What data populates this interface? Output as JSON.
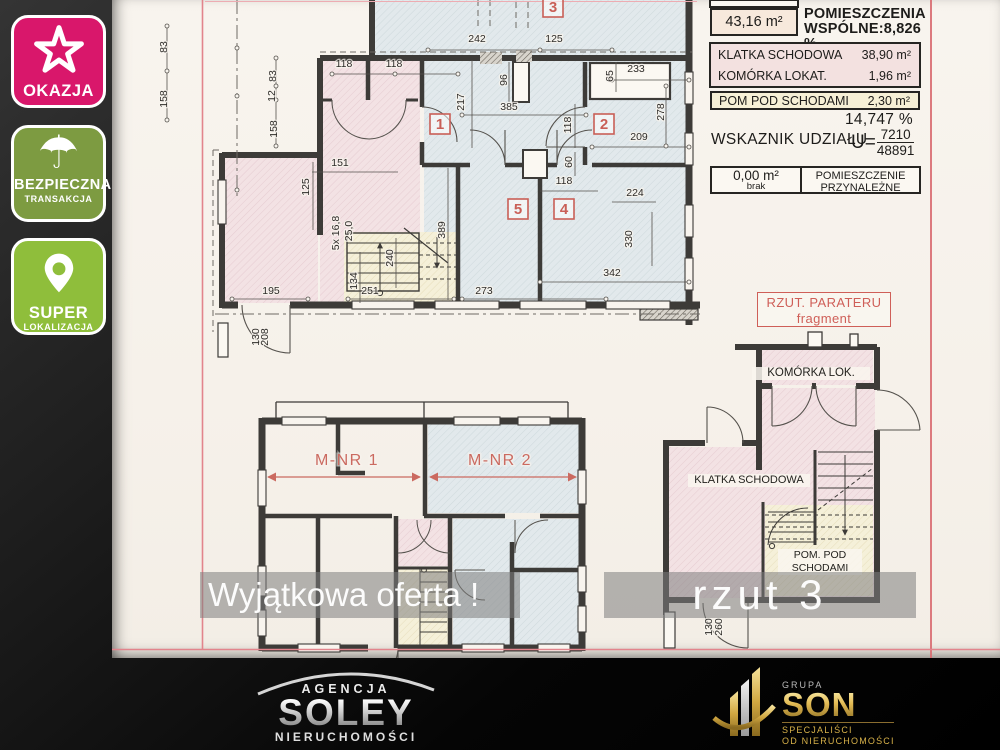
{
  "colors": {
    "accent_red": "#c95f57",
    "border_pink": "#e2848c",
    "badge_pink": "#d9176b",
    "badge_olive": "#7d9b41",
    "badge_green": "#8fbe3b"
  },
  "badges": [
    {
      "label": "OKAZJA",
      "color": "#d9176b",
      "icon": "star-icon"
    },
    {
      "label": "BEZPIECZNA",
      "sublabel": "TRANSAKCJA",
      "color": "#7d9b41",
      "icon": "umbrella-icon"
    },
    {
      "label": "SUPER",
      "sublabel": "LOKALIZACJA",
      "color": "#8fbe3b",
      "icon": "pin-icon"
    }
  ],
  "info_panel": {
    "area_value": "43,16 m²",
    "area_label_line1": "POMIESZCZENIA",
    "area_label_line2": "WSPÓLNE:8,826 %",
    "rows": [
      {
        "label": "KLATKA SCHODOWA",
        "value": "38,90 m²"
      },
      {
        "label": "KOMÓRKA  LOKAT.",
        "value": "1,96 m²"
      },
      {
        "label": "POM POD SCHODAMI",
        "value": "2,30 m²"
      }
    ],
    "share_pct": "14,747 %",
    "share_label": "WSKAZNIK UDZIAŁU",
    "share_u": "U=",
    "share_num": "7210",
    "share_den": "48891",
    "attached_value": "0,00 m²",
    "attached_sub": "brak",
    "attached_label_line1": "POMIESZCZENIE",
    "attached_label_line2": "PRZYNALEŻNE"
  },
  "plan_upper": {
    "room_numbers": [
      {
        "t": "3",
        "x": 553,
        "y": 7
      },
      {
        "t": "1",
        "x": 440,
        "y": 124
      },
      {
        "t": "2",
        "x": 604,
        "y": 124
      },
      {
        "t": "5",
        "x": 518,
        "y": 209
      },
      {
        "t": "4",
        "x": 564,
        "y": 209
      }
    ],
    "dims": [
      {
        "t": "83",
        "x": 167,
        "y": 47,
        "r": -90
      },
      {
        "t": "158",
        "x": 167,
        "y": 99,
        "r": -90
      },
      {
        "t": "83",
        "x": 276,
        "y": 76,
        "r": -90
      },
      {
        "t": "12",
        "x": 275,
        "y": 96,
        "r": -90
      },
      {
        "t": "158",
        "x": 277,
        "y": 129,
        "r": -90
      },
      {
        "t": "242",
        "x": 477,
        "y": 42
      },
      {
        "t": "125",
        "x": 554,
        "y": 42
      },
      {
        "t": "118",
        "x": 344,
        "y": 67
      },
      {
        "t": "118",
        "x": 394,
        "y": 67
      },
      {
        "t": "96",
        "x": 507,
        "y": 80,
        "r": -90
      },
      {
        "t": "217",
        "x": 464,
        "y": 102,
        "r": -90
      },
      {
        "t": "385",
        "x": 509,
        "y": 110
      },
      {
        "t": "65",
        "x": 613,
        "y": 76,
        "r": -90
      },
      {
        "t": "233",
        "x": 636,
        "y": 72
      },
      {
        "t": "278",
        "x": 664,
        "y": 112,
        "r": -90
      },
      {
        "t": "118",
        "x": 571,
        "y": 125,
        "r": -90
      },
      {
        "t": "209",
        "x": 639,
        "y": 140
      },
      {
        "t": "60",
        "x": 572,
        "y": 162,
        "r": -90
      },
      {
        "t": "151",
        "x": 340,
        "y": 166
      },
      {
        "t": "125",
        "x": 309,
        "y": 187,
        "r": -90
      },
      {
        "t": "118",
        "x": 564,
        "y": 184
      },
      {
        "t": "224",
        "x": 635,
        "y": 196
      },
      {
        "t": "5x 16,8",
        "x": 339,
        "y": 233,
        "r": -90,
        "s": 8
      },
      {
        "t": "25,0",
        "x": 352,
        "y": 231,
        "r": -90,
        "s": 8
      },
      {
        "t": "389",
        "x": 445,
        "y": 230,
        "r": -90
      },
      {
        "t": "330",
        "x": 632,
        "y": 239,
        "r": -90
      },
      {
        "t": "240",
        "x": 393,
        "y": 258,
        "r": -90
      },
      {
        "t": "134",
        "x": 357,
        "y": 281,
        "r": -90
      },
      {
        "t": "342",
        "x": 612,
        "y": 276
      },
      {
        "t": "195",
        "x": 271,
        "y": 294
      },
      {
        "t": "251",
        "x": 370,
        "y": 294
      },
      {
        "t": "273",
        "x": 484,
        "y": 294
      },
      {
        "t": "130",
        "x": 259,
        "y": 337,
        "r": -90,
        "s": 9
      },
      {
        "t": "208",
        "x": 268,
        "y": 337,
        "r": -90,
        "s": 9
      }
    ]
  },
  "plan_lower": {
    "units": [
      {
        "t": "M-NR 1",
        "x": 347,
        "y": 465
      },
      {
        "t": "M-NR 2",
        "x": 500,
        "y": 465
      }
    ]
  },
  "plan_fragment": {
    "title": "RZUT. PARATERU",
    "subtitle": "fragment",
    "room_top": "KOMÓRKA LOK.",
    "room_left": "KLATKA SCHODOWA",
    "room_bottom_line1": "POM. POD",
    "room_bottom_line2": "SCHODAMI",
    "dims": [
      {
        "t": "130",
        "x": 712,
        "y": 627,
        "r": -90,
        "s": 9
      },
      {
        "t": "260",
        "x": 722,
        "y": 627,
        "r": -90,
        "s": 9
      }
    ]
  },
  "watermarks": {
    "offer": "Wyjątkowa oferta !",
    "rzut": "rzut 3"
  },
  "logos": {
    "soley": {
      "top": "AGENCJA",
      "main": "SOLEY",
      "bottom": "NIERUCHOMOŚCI"
    },
    "son": {
      "top": "GRUPA",
      "main": "SON",
      "line1": "SPECJALIŚCI",
      "line2": "OD NIERUCHOMOŚCI"
    }
  }
}
